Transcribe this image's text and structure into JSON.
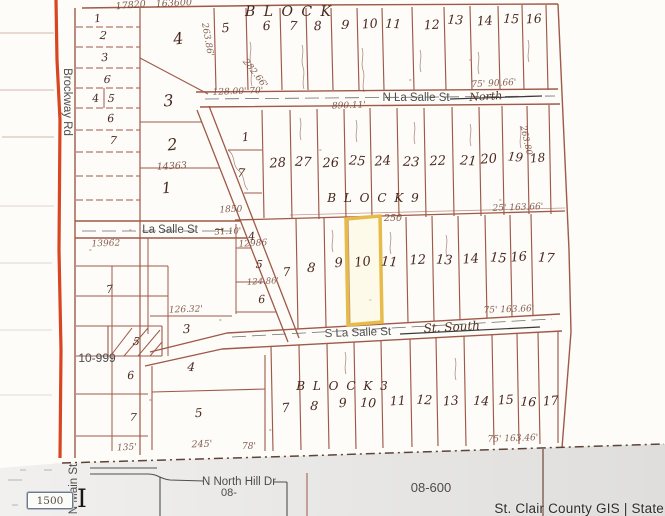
{
  "map": {
    "colors": {
      "highlight": "#e7bb49",
      "road": "#d5350e",
      "parcel_line": "#9e5948"
    },
    "highlighted_lot": "10",
    "labels": [
      {
        "t": "Brockway Rd",
        "x": 64,
        "y": 102,
        "s": 11.5,
        "r": 90,
        "c": "print",
        "n": "street-label-brockway-rd"
      },
      {
        "t": "N La Salle St",
        "x": 416,
        "y": 101,
        "s": 11.5,
        "c": "print",
        "n": "street-label-n-la-salle-st"
      },
      {
        "t": "North",
        "x": 486,
        "y": 100,
        "s": 11,
        "r": -3,
        "c": "script",
        "n": "hand-label-north"
      },
      {
        "t": "La Salle St",
        "x": 170,
        "y": 233,
        "s": 11.5,
        "c": "print",
        "n": "street-label-la-salle-st"
      },
      {
        "t": "→",
        "x": 219,
        "y": 233,
        "s": 11,
        "c": "script",
        "n": "arrow-mark"
      },
      {
        "t": "S La Salle St",
        "x": 358,
        "y": 336,
        "s": 11.5,
        "r": -2,
        "c": "print",
        "n": "street-label-s-la-salle-st"
      },
      {
        "t": "St. South",
        "x": 452,
        "y": 331,
        "s": 12,
        "r": -3,
        "c": "script",
        "n": "hand-label-st-south"
      },
      {
        "t": "N North Hill Dr",
        "x": 239,
        "y": 485,
        "s": 11.5,
        "c": "print",
        "n": "street-label-n-north-hill-dr"
      },
      {
        "t": "08-",
        "x": 229,
        "y": 496,
        "s": 11,
        "c": "print",
        "n": "area-label-08"
      },
      {
        "t": "N Main St",
        "x": 77,
        "y": 489,
        "s": 11.5,
        "r": -90,
        "c": "print",
        "n": "street-label-n-main-st"
      },
      {
        "t": "08-600",
        "x": 431,
        "y": 492,
        "s": 13,
        "c": "print",
        "n": "area-label-08-600"
      },
      {
        "t": "10-999",
        "x": 97,
        "y": 362,
        "s": 12,
        "c": "print",
        "n": "area-label-10-999"
      },
      {
        "t": "B L O C K",
        "x": 289,
        "y": 16,
        "s": 14,
        "c": "block",
        "n": "block-label-top"
      },
      {
        "t": "B L O C K   9",
        "x": 374,
        "y": 202,
        "s": 12,
        "c": "block",
        "n": "block-label-9"
      },
      {
        "t": "B L O C K   3",
        "x": 343,
        "y": 390,
        "s": 12,
        "c": "block",
        "n": "block-label-3"
      },
      {
        "t": "17820",
        "x": 131,
        "y": 8,
        "s": 9.5,
        "r": -5,
        "c": "dim"
      },
      {
        "t": "163600",
        "x": 174,
        "y": 6,
        "s": 9.5,
        "r": -3,
        "c": "dim"
      },
      {
        "t": "263.86'",
        "x": 205,
        "y": 40,
        "s": 9,
        "r": 80,
        "c": "dim"
      },
      {
        "t": "282.66'",
        "x": 253,
        "y": 75,
        "s": 9,
        "r": 52,
        "c": "dim"
      },
      {
        "t": "128.00'  70'",
        "x": 238,
        "y": 94,
        "s": 9,
        "r": -2,
        "c": "dim"
      },
      {
        "t": "890.11'",
        "x": 349,
        "y": 108,
        "s": 9,
        "r": -2,
        "c": "dim"
      },
      {
        "t": "75'  90.66'",
        "x": 494,
        "y": 86,
        "s": 9,
        "r": -3,
        "c": "dim"
      },
      {
        "t": "263.80'",
        "x": 524,
        "y": 142,
        "s": 8.5,
        "r": 78,
        "c": "dim"
      },
      {
        "t": "25'  163.66'",
        "x": 518,
        "y": 210,
        "s": 9,
        "r": -2,
        "c": "dim"
      },
      {
        "t": "250",
        "x": 393,
        "y": 221,
        "s": 9.5,
        "c": "dim"
      },
      {
        "t": "1850",
        "x": 231,
        "y": 212,
        "s": 9,
        "r": -3,
        "c": "dim"
      },
      {
        "t": "31.10'",
        "x": 228,
        "y": 234,
        "s": 8.5,
        "r": -3,
        "c": "dim"
      },
      {
        "t": "12986",
        "x": 253,
        "y": 246,
        "s": 9,
        "r": -3,
        "c": "dim"
      },
      {
        "t": "124.86'",
        "x": 263,
        "y": 284,
        "s": 8.5,
        "r": -3,
        "c": "dim"
      },
      {
        "t": "13962",
        "x": 106,
        "y": 246,
        "s": 9,
        "r": -2,
        "c": "dim"
      },
      {
        "t": "14363",
        "x": 172,
        "y": 169,
        "s": 9.5,
        "r": -3,
        "c": "dim"
      },
      {
        "t": "75'  163.66'",
        "x": 509,
        "y": 312,
        "s": 9,
        "r": -2,
        "c": "dim"
      },
      {
        "t": "126.32'",
        "x": 186,
        "y": 312,
        "s": 9,
        "r": -2,
        "c": "dim"
      },
      {
        "t": "75'  163.46'",
        "x": 513,
        "y": 441,
        "s": 9,
        "r": -2,
        "c": "dim"
      },
      {
        "t": "245'",
        "x": 202,
        "y": 447,
        "s": 9.5,
        "r": -2,
        "c": "dim"
      },
      {
        "t": "135'",
        "x": 127,
        "y": 450,
        "s": 9,
        "r": -3,
        "c": "dim"
      },
      {
        "t": "78'",
        "x": 249,
        "y": 449,
        "s": 9,
        "c": "dim"
      },
      {
        "t": "5",
        "x": 226,
        "y": 32,
        "s": 12.5,
        "r": -5,
        "c": "hand"
      },
      {
        "t": "6",
        "x": 267,
        "y": 30,
        "s": 12.5,
        "r": -4,
        "c": "hand"
      },
      {
        "t": "7",
        "x": 293,
        "y": 30,
        "s": 12.5,
        "r": 4,
        "c": "hand"
      },
      {
        "t": "8",
        "x": 318,
        "y": 30,
        "s": 12.5,
        "r": -3,
        "c": "hand"
      },
      {
        "t": "9",
        "x": 345,
        "y": 29,
        "s": 12.5,
        "r": 5,
        "c": "hand"
      },
      {
        "t": "10",
        "x": 370,
        "y": 28,
        "s": 12.5,
        "r": -4,
        "c": "hand"
      },
      {
        "t": "11",
        "x": 393,
        "y": 28,
        "s": 12.5,
        "r": 3,
        "c": "hand"
      },
      {
        "t": "12",
        "x": 432,
        "y": 29,
        "s": 12.5,
        "r": -3,
        "c": "hand"
      },
      {
        "t": "13",
        "x": 455,
        "y": 24,
        "s": 12.5,
        "r": 4,
        "c": "hand"
      },
      {
        "t": "14",
        "x": 485,
        "y": 25,
        "s": 12.5,
        "r": -4,
        "c": "hand"
      },
      {
        "t": "15",
        "x": 511,
        "y": 23,
        "s": 12.5,
        "r": 3,
        "c": "hand"
      },
      {
        "t": "16",
        "x": 534,
        "y": 23,
        "s": 12.5,
        "r": -3,
        "c": "hand"
      },
      {
        "t": "1",
        "x": 98,
        "y": 22,
        "s": 11,
        "r": -6,
        "c": "hand"
      },
      {
        "t": "2",
        "x": 103,
        "y": 39,
        "s": 11,
        "r": 5,
        "c": "hand"
      },
      {
        "t": "3",
        "x": 105,
        "y": 61,
        "s": 11,
        "r": -4,
        "c": "hand"
      },
      {
        "t": "6",
        "x": 107,
        "y": 83,
        "s": 11,
        "r": 4,
        "c": "hand"
      },
      {
        "t": "4",
        "x": 96,
        "y": 102,
        "s": 11,
        "r": -5,
        "c": "hand"
      },
      {
        "t": "5",
        "x": 111,
        "y": 102,
        "s": 11,
        "r": 4,
        "c": "hand"
      },
      {
        "t": "6",
        "x": 111,
        "y": 122,
        "s": 11,
        "r": -4,
        "c": "hand"
      },
      {
        "t": "7",
        "x": 113,
        "y": 144,
        "s": 11,
        "r": 5,
        "c": "hand"
      },
      {
        "t": "4",
        "x": 179,
        "y": 44,
        "s": 16,
        "r": -8,
        "c": "hand"
      },
      {
        "t": "3",
        "x": 169,
        "y": 106,
        "s": 16,
        "r": -5,
        "c": "hand"
      },
      {
        "t": "2",
        "x": 173,
        "y": 150,
        "s": 16,
        "r": -6,
        "c": "hand"
      },
      {
        "t": "1",
        "x": 167,
        "y": 193,
        "s": 15,
        "r": -5,
        "c": "hand"
      },
      {
        "t": "1",
        "x": 246,
        "y": 141,
        "s": 12,
        "r": -5,
        "c": "hand"
      },
      {
        "t": "7",
        "x": 241,
        "y": 177,
        "s": 12,
        "r": 4,
        "c": "hand"
      },
      {
        "t": "28",
        "x": 278,
        "y": 167,
        "s": 13,
        "r": -4,
        "c": "hand"
      },
      {
        "t": "27",
        "x": 303,
        "y": 166,
        "s": 13,
        "r": 3,
        "c": "hand"
      },
      {
        "t": "26",
        "x": 331,
        "y": 167,
        "s": 13,
        "r": -3,
        "c": "hand"
      },
      {
        "t": "25",
        "x": 357,
        "y": 165,
        "s": 13,
        "r": 4,
        "c": "hand"
      },
      {
        "t": "24",
        "x": 383,
        "y": 165,
        "s": 13,
        "r": -4,
        "c": "hand"
      },
      {
        "t": "23",
        "x": 411,
        "y": 166,
        "s": 13,
        "r": 3,
        "c": "hand"
      },
      {
        "t": "22",
        "x": 438,
        "y": 165,
        "s": 13,
        "r": -3,
        "c": "hand"
      },
      {
        "t": "21",
        "x": 468,
        "y": 165,
        "s": 13,
        "r": 4,
        "c": "hand"
      },
      {
        "t": "20",
        "x": 489,
        "y": 163,
        "s": 13,
        "r": -4,
        "c": "hand"
      },
      {
        "t": "19",
        "x": 515,
        "y": 161,
        "s": 12,
        "r": 6,
        "c": "hand"
      },
      {
        "t": "18",
        "x": 538,
        "y": 162,
        "s": 12,
        "r": -5,
        "c": "hand"
      },
      {
        "t": "7",
        "x": 287,
        "y": 276,
        "s": 12,
        "r": -4,
        "c": "hand"
      },
      {
        "t": "8",
        "x": 311,
        "y": 272,
        "s": 13,
        "r": 4,
        "c": "hand"
      },
      {
        "t": "9",
        "x": 339,
        "y": 267,
        "s": 13,
        "r": -4,
        "c": "hand"
      },
      {
        "t": "10",
        "x": 363,
        "y": 266,
        "s": 13,
        "r": -6,
        "c": "hand"
      },
      {
        "t": "11",
        "x": 389,
        "y": 266,
        "s": 13,
        "r": 4,
        "c": "hand"
      },
      {
        "t": "12",
        "x": 418,
        "y": 264,
        "s": 13,
        "r": -3,
        "c": "hand"
      },
      {
        "t": "13",
        "x": 444,
        "y": 264,
        "s": 13,
        "r": 4,
        "c": "hand"
      },
      {
        "t": "14",
        "x": 471,
        "y": 263,
        "s": 13,
        "r": -4,
        "c": "hand"
      },
      {
        "t": "15",
        "x": 498,
        "y": 262,
        "s": 13,
        "r": 5,
        "c": "hand"
      },
      {
        "t": "16",
        "x": 519,
        "y": 261,
        "s": 13,
        "r": -4,
        "c": "hand"
      },
      {
        "t": "17",
        "x": 546,
        "y": 262,
        "s": 13,
        "r": 4,
        "c": "hand"
      },
      {
        "t": "4",
        "x": 252,
        "y": 240,
        "s": 11,
        "r": -4,
        "c": "hand"
      },
      {
        "t": "5",
        "x": 259,
        "y": 268,
        "s": 11,
        "r": 4,
        "c": "hand"
      },
      {
        "t": "6",
        "x": 262,
        "y": 303,
        "s": 11,
        "r": -4,
        "c": "hand"
      },
      {
        "t": "7",
        "x": 110,
        "y": 293,
        "s": 11,
        "r": -5,
        "c": "hand"
      },
      {
        "t": "3",
        "x": 187,
        "y": 333,
        "s": 12,
        "r": -4,
        "c": "hand"
      },
      {
        "t": "4",
        "x": 191,
        "y": 371,
        "s": 12,
        "r": 4,
        "c": "hand"
      },
      {
        "t": "5",
        "x": 199,
        "y": 417,
        "s": 12,
        "r": -4,
        "c": "hand"
      },
      {
        "t": "5",
        "x": 136,
        "y": 345,
        "s": 11,
        "r": 5,
        "c": "hand"
      },
      {
        "t": "6",
        "x": 131,
        "y": 379,
        "s": 11,
        "r": -4,
        "c": "hand"
      },
      {
        "t": "7",
        "x": 133,
        "y": 421,
        "s": 11,
        "r": 4,
        "c": "hand"
      },
      {
        "t": "7",
        "x": 286,
        "y": 412,
        "s": 12.5,
        "r": -4,
        "c": "hand"
      },
      {
        "t": "8",
        "x": 314,
        "y": 410,
        "s": 12.5,
        "r": 4,
        "c": "hand"
      },
      {
        "t": "9",
        "x": 343,
        "y": 407,
        "s": 12.5,
        "r": -3,
        "c": "hand"
      },
      {
        "t": "10",
        "x": 368,
        "y": 407,
        "s": 12.5,
        "r": 3,
        "c": "hand"
      },
      {
        "t": "11",
        "x": 398,
        "y": 405,
        "s": 12.5,
        "r": -3,
        "c": "hand"
      },
      {
        "t": "12",
        "x": 424,
        "y": 404,
        "s": 12.5,
        "r": 4,
        "c": "hand"
      },
      {
        "t": "13",
        "x": 451,
        "y": 405,
        "s": 12.5,
        "r": -4,
        "c": "hand"
      },
      {
        "t": "14",
        "x": 481,
        "y": 405,
        "s": 12.5,
        "r": 3,
        "c": "hand"
      },
      {
        "t": "15",
        "x": 506,
        "y": 404,
        "s": 12.5,
        "r": -3,
        "c": "hand"
      },
      {
        "t": "16",
        "x": 528,
        "y": 406,
        "s": 12.5,
        "r": 4,
        "c": "hand"
      },
      {
        "t": "17",
        "x": 551,
        "y": 405,
        "s": 12.5,
        "r": -4,
        "c": "hand"
      }
    ]
  },
  "badge": {
    "text": "1500"
  },
  "cursor": {
    "glyph": "I"
  },
  "attribution": {
    "text": "St. Clair County GIS | State"
  }
}
